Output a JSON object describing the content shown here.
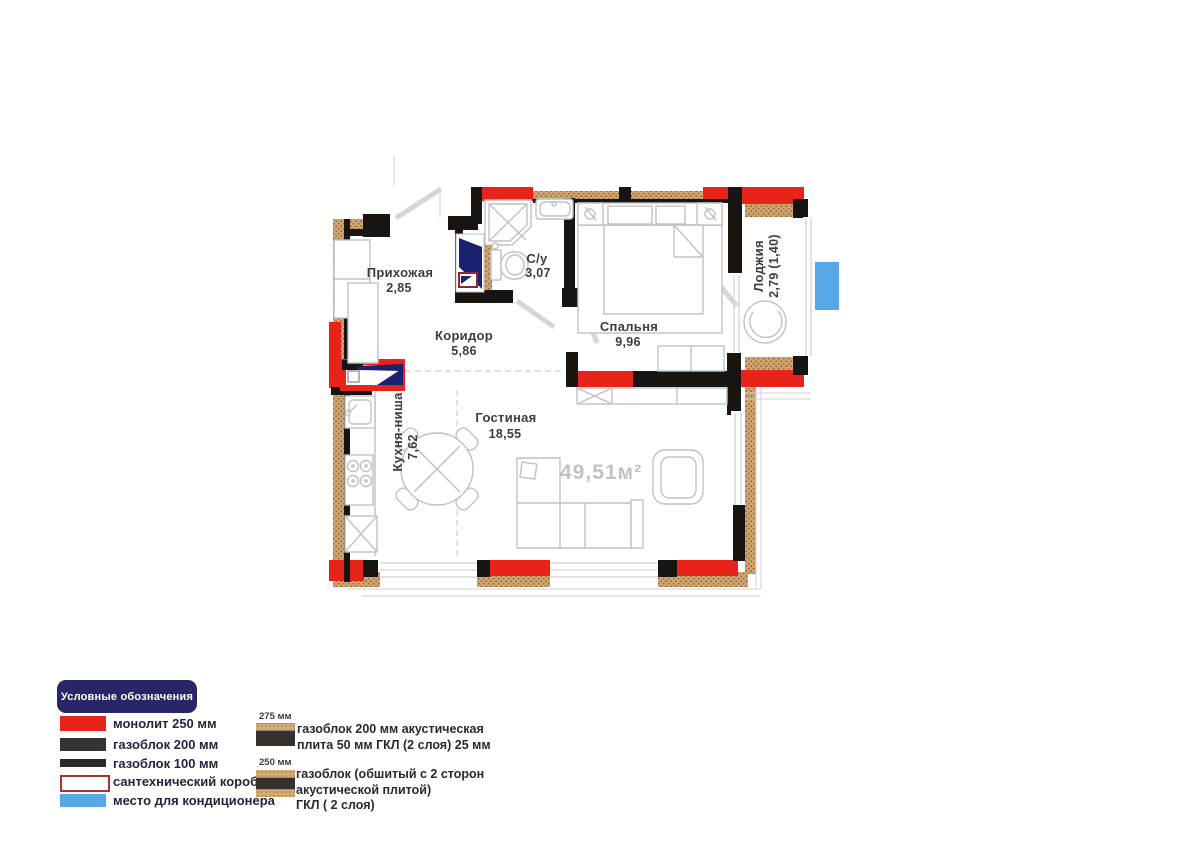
{
  "plan": {
    "total_area_watermark": "49,51м²",
    "rooms": {
      "hallway": {
        "name": "Прихожая",
        "area": "2,85"
      },
      "bathroom": {
        "name": "С/у",
        "area": "3,07"
      },
      "corridor": {
        "name": "Коридор",
        "area": "5,86"
      },
      "bedroom": {
        "name": "Спальня",
        "area": "9,96"
      },
      "loggia": {
        "name": "Лоджия",
        "area": "2,79 (1,40)"
      },
      "kitchen": {
        "name": "Кухня-ниша",
        "area": "7,62"
      },
      "living": {
        "name": "Гостиная",
        "area": "18,55"
      }
    }
  },
  "legend": {
    "title": "Условные обозначения",
    "items": [
      {
        "label": "монолит 250 мм"
      },
      {
        "label": "газоблок 200 мм"
      },
      {
        "label": "газоблок 100 мм"
      },
      {
        "label": "сантехнический короб"
      },
      {
        "label": "место для кондиционера"
      }
    ],
    "wall_types": [
      {
        "size": "275 мм",
        "lines": [
          "газоблок 200 мм акустическая",
          "плита 50 мм ГКЛ (2 слоя) 25 мм"
        ]
      },
      {
        "size": "250 мм",
        "lines": [
          "газоблок (обшитый с 2 сторон",
          "акустической плитой)",
          "ГКЛ ( 2 слоя)"
        ]
      }
    ],
    "colors": {
      "monolith_red": "#e8231a",
      "gasblock_dark": "#35302e",
      "sanitary_outline": "#a93527",
      "ac_blue": "#58a8e8",
      "title_navy": "#292667",
      "insulation_tan": "#d4ad75",
      "plumbing_navy": "#1b2170"
    }
  }
}
